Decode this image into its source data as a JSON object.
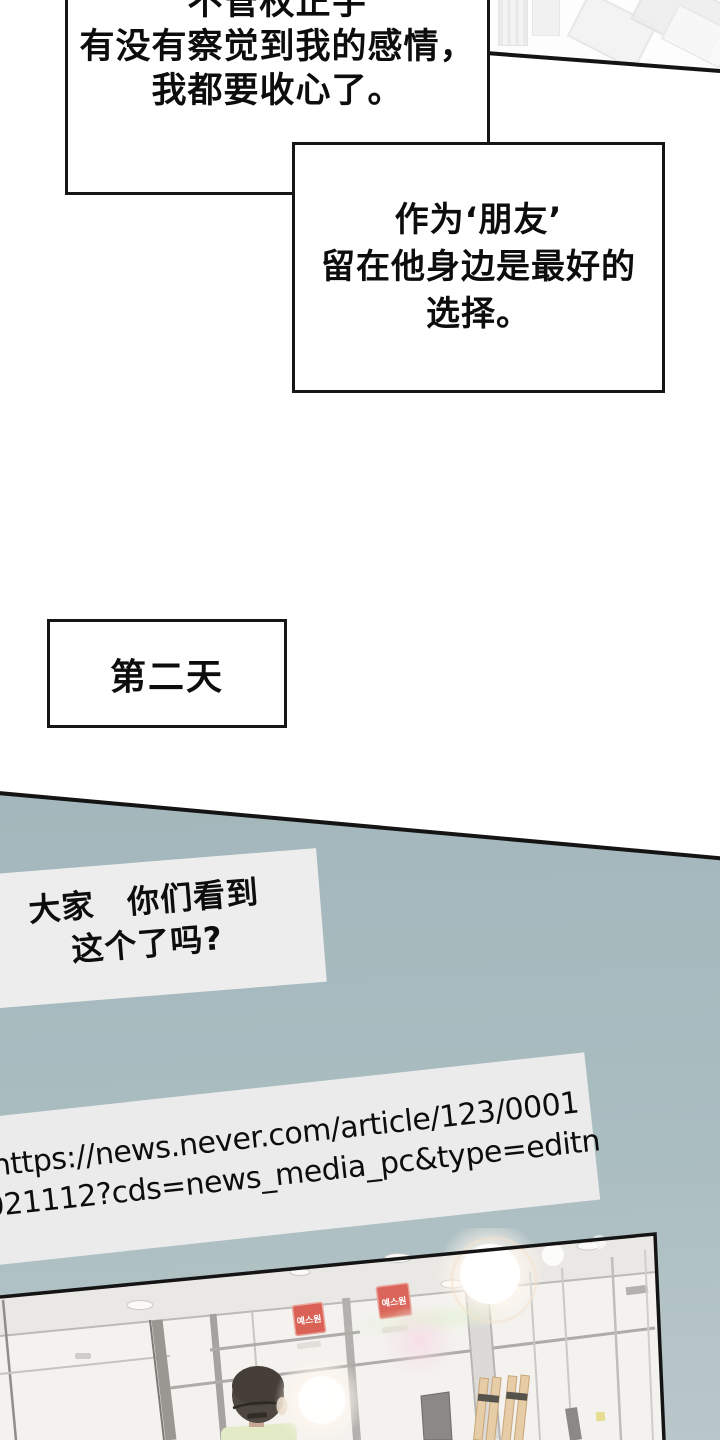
{
  "comic": {
    "speech1": {
      "line1": "不管权正宇",
      "line2": "有没有察觉到我的感情，",
      "line3": "我都要收心了。"
    },
    "speech2": {
      "line1": "作为‘朋友’",
      "line2": "留在他身边是最好的",
      "line3": "选择。"
    },
    "day_caption": "第二天",
    "speech3": {
      "line1": "大家　你们看到",
      "line2": "这个了吗?"
    },
    "url_note": {
      "line1": "https://news.never.com/article/123/0001",
      "line2": "021112?cds=news_media_pc&type=editn"
    },
    "storefront": {
      "sign_text": "예스원"
    }
  },
  "colors": {
    "section_gray_blue": "#a9bcc0",
    "box_border_black": "#161616",
    "note_box_gray": "#ededed",
    "sign_red": "#d96156",
    "shirt_green": "#e3ebc6",
    "panel_white": "#f3f2ef"
  }
}
